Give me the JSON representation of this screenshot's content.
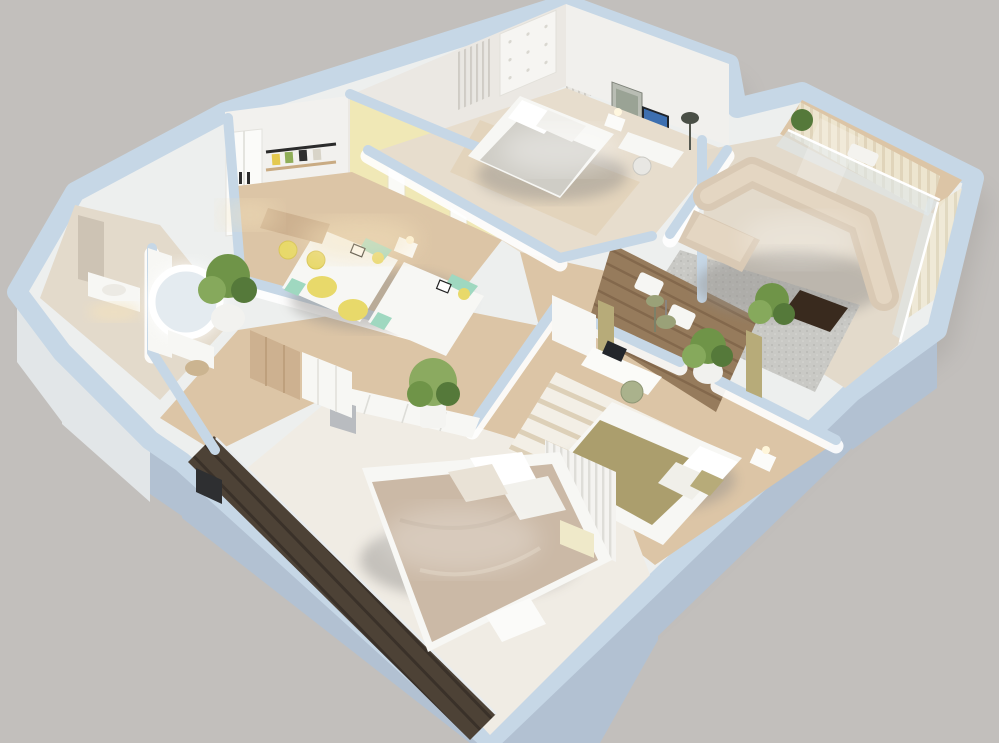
{
  "scene": {
    "kind": "3d-floorplan-render",
    "description": "Isometric 3D render of an apartment floor plan on a plain gray backdrop",
    "rooms": [
      {
        "name": "top-bedroom",
        "furniture": [
          "double-bed",
          "tufted-headboard-panel",
          "curtain-panels",
          "nightstand-lamp",
          "artwork-frame",
          "tv-screen",
          "desk",
          "floor-lamp",
          "area-rug"
        ]
      },
      {
        "name": "kids-bedroom",
        "furniture": [
          "single-bed",
          "single-bed",
          "nightstand-lamp",
          "desk",
          "desk-chair",
          "desk-chair",
          "wall-shelving",
          "wardrobe",
          "bean-bag",
          "bean-bag",
          "wall-posters"
        ]
      },
      {
        "name": "living-room",
        "furniture": [
          "corner-sofa",
          "gray-rug",
          "coffee-table",
          "potted-plant",
          "glass-walls",
          "vertical-blinds"
        ]
      },
      {
        "name": "terrace",
        "furniture": [
          "wood-deck",
          "lounge-chair",
          "lounge-chair",
          "potted-plant",
          "floor-lamp",
          "olive-curtains"
        ]
      },
      {
        "name": "right-bedroom",
        "furniture": [
          "double-bed-olive",
          "striped-rug",
          "desk",
          "monitor",
          "office-chair",
          "pendant-lamp",
          "storage-unit",
          "nightstand-lamp"
        ]
      },
      {
        "name": "master-bedroom",
        "furniture": [
          "double-bed",
          "white-carpet",
          "bench",
          "slatted-headboard-wall",
          "nightstand",
          "closet-row",
          "potted-plant"
        ]
      },
      {
        "name": "balcony",
        "furniture": [
          "dark-wood-deck",
          "glass-balustrade"
        ]
      },
      {
        "name": "bathroom",
        "furniture": [
          "wall-mirror",
          "vanity-sink",
          "under-cabinet-glow"
        ]
      },
      {
        "name": "dressing-area",
        "furniture": [
          "round-led-mirror",
          "vanity-table",
          "stool",
          "potted-plant"
        ]
      },
      {
        "name": "hallway",
        "furniture": [
          "wardrobe-row",
          "entry-door",
          "potted-plant"
        ]
      }
    ]
  },
  "palette": {
    "bg": "#c2bfbc",
    "slab": "#edefee",
    "wall_top": "#c6d7e6",
    "wall_face": "#f2f1ee",
    "wall_outer": "#b2c1d2",
    "floor_marble": "#e7ddcd",
    "floor_wood": "#dcc5a6",
    "floor_light": "#e3dacb",
    "carpet": "#f0ece4",
    "rug_gray": "#c9c9c5",
    "accent_yellow_wall": "#f0e8b6",
    "accent_yellow": "#e8d96a",
    "mint": "#9fd8c0",
    "duvet_taupe": "#cbb9a6",
    "duvet_olive": "#ab9e6d",
    "sofa_beige": "#d9c9b4",
    "table_dark": "#392a1e",
    "deck_dark": "#4d4236",
    "deck_mid": "#967b5c",
    "plant_green": "#6f9448",
    "wood_closet": "#cdb190",
    "glass_blue": "#dfe9ef",
    "blind_cream": "#efe8d4",
    "glow_warm": "#f6e3bc"
  }
}
